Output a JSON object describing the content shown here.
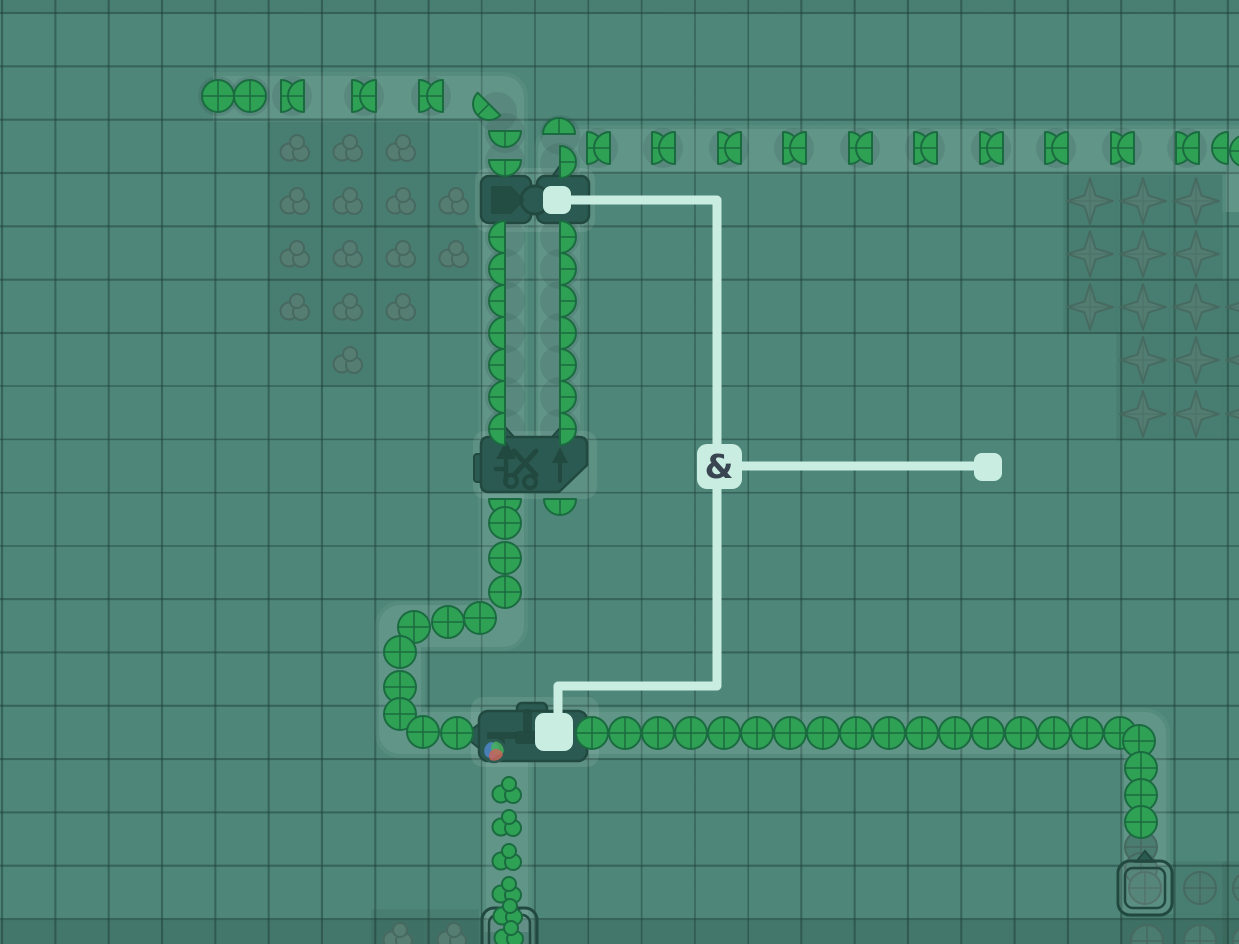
{
  "meta": {
    "view": "factory-wire-layer",
    "width": 1239,
    "height": 944
  },
  "colors": {
    "base": "#4e8679",
    "machine": "#2b5a52",
    "machine_dark": "#22493f",
    "wire": "#c9eee1",
    "gate_bg": "#c9eee1",
    "gate_text": "#394551",
    "item_green": "#2fa155",
    "item_green_dark": "#1b6b40",
    "dim_fill": "#557d72",
    "dim_stroke": "#47695f",
    "dim_circle_fill": "#4a7c70",
    "belt_band": "rgba(222,248,240,0.09)",
    "belt_halo": "rgba(222,248,240,0.05)",
    "halo": "rgba(222,248,240,0.10)",
    "patch_cell": "rgba(18,44,38,0.09)",
    "ghost": "rgba(18,44,38,0.10)",
    "orb_blue": "#4f86c9",
    "orb_green": "#46b25e",
    "orb_red": "#c9655b"
  },
  "gate": {
    "label": "&",
    "x": 719,
    "y": 466,
    "size": 45
  },
  "pins": [
    {
      "x": 988,
      "y": 467,
      "size": 28
    }
  ],
  "wires": [
    [
      [
        571,
        200
      ],
      [
        717,
        200
      ],
      [
        717,
        446
      ]
    ],
    [
      [
        717,
        486
      ],
      [
        717,
        686
      ],
      [
        558,
        686
      ],
      [
        558,
        715
      ]
    ],
    [
      [
        740,
        466
      ],
      [
        976,
        466
      ]
    ]
  ],
  "belts": [
    [
      [
        213,
        97
      ],
      [
        503,
        97
      ],
      [
        503,
        180
      ]
    ],
    [
      [
        503,
        222
      ],
      [
        503,
        440
      ]
    ],
    [
      [
        559,
        222
      ],
      [
        559,
        440
      ]
    ],
    [
      [
        559,
        180
      ],
      [
        559,
        150
      ],
      [
        1247,
        150
      ],
      [
        1247,
        212
      ]
    ],
    [
      [
        503,
        488
      ],
      [
        503,
        626
      ],
      [
        400,
        626
      ],
      [
        400,
        733
      ],
      [
        480,
        733
      ]
    ],
    [
      [
        586,
        733
      ],
      [
        1145,
        733
      ],
      [
        1145,
        866
      ]
    ],
    [
      [
        507,
        758
      ],
      [
        507,
        932
      ]
    ]
  ],
  "halos": [
    [
      475,
      168,
      120,
      64
    ],
    [
      473,
      431,
      124,
      68
    ],
    [
      471,
      697,
      128,
      70
    ]
  ],
  "machines": [
    {
      "type": "processor",
      "x": 481,
      "y": 174
    },
    {
      "type": "cutter",
      "x": 481,
      "y": 437
    },
    {
      "type": "filter",
      "x": 479,
      "y": 703
    },
    {
      "type": "miner",
      "x": 482,
      "y": 908,
      "w": 55
    },
    {
      "type": "miner",
      "x": 1118,
      "y": 861,
      "w": 54
    }
  ],
  "patch_cells": [
    [
      295,
      148
    ],
    [
      348,
      148
    ],
    [
      401,
      148
    ],
    [
      295,
      201
    ],
    [
      348,
      201
    ],
    [
      401,
      201
    ],
    [
      454,
      201
    ],
    [
      295,
      254
    ],
    [
      348,
      254
    ],
    [
      401,
      254
    ],
    [
      454,
      254
    ],
    [
      295,
      307
    ],
    [
      348,
      307
    ],
    [
      401,
      307
    ],
    [
      348,
      360
    ],
    [
      398,
      936
    ],
    [
      452,
      936
    ],
    [
      1090,
      201
    ],
    [
      1143,
      201
    ],
    [
      1196,
      201
    ],
    [
      1090,
      254
    ],
    [
      1143,
      254
    ],
    [
      1196,
      254
    ],
    [
      1090,
      307
    ],
    [
      1143,
      307
    ],
    [
      1196,
      307
    ],
    [
      1249,
      307
    ],
    [
      1143,
      360
    ],
    [
      1196,
      360
    ],
    [
      1249,
      360
    ],
    [
      1143,
      414
    ],
    [
      1196,
      414
    ],
    [
      1249,
      414
    ],
    [
      1200,
      888
    ],
    [
      1147,
      941
    ],
    [
      1200,
      941
    ],
    [
      1249,
      888
    ],
    [
      1249,
      941
    ]
  ],
  "dim_sprites": [
    [
      295,
      148,
      "cluster"
    ],
    [
      348,
      148,
      "cluster"
    ],
    [
      401,
      148,
      "cluster"
    ],
    [
      295,
      201,
      "cluster"
    ],
    [
      348,
      201,
      "cluster"
    ],
    [
      401,
      201,
      "cluster"
    ],
    [
      454,
      201,
      "cluster"
    ],
    [
      295,
      254,
      "cluster"
    ],
    [
      348,
      254,
      "cluster"
    ],
    [
      401,
      254,
      "cluster"
    ],
    [
      454,
      254,
      "cluster"
    ],
    [
      295,
      307,
      "cluster"
    ],
    [
      348,
      307,
      "cluster"
    ],
    [
      401,
      307,
      "cluster"
    ],
    [
      348,
      360,
      "cluster"
    ],
    [
      398,
      936,
      "cluster"
    ],
    [
      452,
      936,
      "cluster"
    ],
    [
      1090,
      201,
      "star"
    ],
    [
      1143,
      201,
      "star"
    ],
    [
      1196,
      201,
      "star"
    ],
    [
      1090,
      254,
      "star"
    ],
    [
      1143,
      254,
      "star"
    ],
    [
      1196,
      254,
      "star"
    ],
    [
      1090,
      307,
      "star"
    ],
    [
      1143,
      307,
      "star"
    ],
    [
      1196,
      307,
      "star"
    ],
    [
      1249,
      307,
      "star"
    ],
    [
      1143,
      360,
      "star"
    ],
    [
      1196,
      360,
      "star"
    ],
    [
      1249,
      360,
      "star"
    ],
    [
      1143,
      414,
      "star"
    ],
    [
      1196,
      414,
      "star"
    ],
    [
      1249,
      414,
      "star"
    ],
    [
      1141,
      847,
      "circle"
    ],
    [
      1141,
      869,
      "circle"
    ],
    [
      1200,
      888,
      "circle"
    ],
    [
      1147,
      941,
      "circle"
    ],
    [
      1200,
      941,
      "circle"
    ],
    [
      1249,
      888,
      "circle"
    ],
    [
      1249,
      941,
      "circle"
    ],
    [
      1145,
      888,
      "circle"
    ]
  ],
  "ghosts": [
    [
      218,
      96
    ],
    [
      250,
      96
    ],
    [
      292,
      96
    ],
    [
      364,
      96
    ],
    [
      431,
      96
    ],
    [
      497,
      112
    ],
    [
      598,
      148
    ],
    [
      663,
      148
    ],
    [
      729,
      148
    ],
    [
      794,
      148
    ],
    [
      860,
      148
    ],
    [
      925,
      148
    ],
    [
      991,
      148
    ],
    [
      1056,
      148
    ],
    [
      1122,
      148
    ],
    [
      1187,
      148
    ],
    [
      505,
      133
    ],
    [
      505,
      161
    ],
    [
      560,
      135
    ],
    [
      560,
      163
    ],
    [
      505,
      237
    ],
    [
      505,
      269
    ],
    [
      505,
      301
    ],
    [
      505,
      333
    ],
    [
      505,
      365
    ],
    [
      505,
      397
    ],
    [
      505,
      429
    ],
    [
      560,
      237
    ],
    [
      560,
      269
    ],
    [
      560,
      301
    ],
    [
      560,
      333
    ],
    [
      560,
      365
    ],
    [
      560,
      397
    ],
    [
      560,
      429
    ]
  ],
  "items": [
    [
      218,
      96,
      "c"
    ],
    [
      250,
      96,
      "c"
    ],
    [
      281,
      96,
      "hr"
    ],
    [
      304,
      96,
      "hl"
    ],
    [
      352,
      96,
      "hr"
    ],
    [
      376,
      96,
      "hl"
    ],
    [
      419,
      96,
      "hr"
    ],
    [
      443,
      96,
      "hl"
    ],
    [
      489,
      104,
      "hl",
      -45
    ],
    [
      505,
      131,
      "hl",
      -90
    ],
    [
      505,
      160,
      "hl",
      -90
    ],
    [
      559,
      134,
      "hl",
      90
    ],
    [
      560,
      162,
      "hr"
    ],
    [
      587,
      148,
      "hr"
    ],
    [
      610,
      148,
      "hl"
    ],
    [
      652,
      148,
      "hr"
    ],
    [
      675,
      148,
      "hl"
    ],
    [
      718,
      148,
      "hr"
    ],
    [
      741,
      148,
      "hl"
    ],
    [
      783,
      148,
      "hr"
    ],
    [
      806,
      148,
      "hl"
    ],
    [
      849,
      148,
      "hr"
    ],
    [
      872,
      148,
      "hl"
    ],
    [
      914,
      148,
      "hr"
    ],
    [
      937,
      148,
      "hl"
    ],
    [
      980,
      148,
      "hr"
    ],
    [
      1003,
      148,
      "hl"
    ],
    [
      1045,
      148,
      "hr"
    ],
    [
      1068,
      148,
      "hl"
    ],
    [
      1111,
      148,
      "hr"
    ],
    [
      1134,
      148,
      "hl"
    ],
    [
      1176,
      148,
      "hr"
    ],
    [
      1199,
      148,
      "hl"
    ],
    [
      1228,
      148,
      "hl"
    ],
    [
      1246,
      151,
      "c"
    ],
    [
      505,
      237,
      "hl"
    ],
    [
      505,
      269,
      "hl"
    ],
    [
      505,
      301,
      "hl"
    ],
    [
      505,
      333,
      "hl"
    ],
    [
      505,
      365,
      "hl"
    ],
    [
      505,
      397,
      "hl"
    ],
    [
      505,
      429,
      "hl"
    ],
    [
      560,
      237,
      "hr"
    ],
    [
      560,
      269,
      "hr"
    ],
    [
      560,
      301,
      "hr"
    ],
    [
      560,
      333,
      "hr"
    ],
    [
      560,
      365,
      "hr"
    ],
    [
      560,
      397,
      "hr"
    ],
    [
      560,
      429,
      "hr"
    ],
    [
      505,
      499,
      "hl",
      -90
    ],
    [
      560,
      499,
      "hl",
      -90
    ],
    [
      505,
      523,
      "c"
    ],
    [
      505,
      558,
      "c"
    ],
    [
      505,
      592,
      "c"
    ],
    [
      480,
      618,
      "c"
    ],
    [
      448,
      622,
      "c"
    ],
    [
      414,
      627,
      "c"
    ],
    [
      400,
      652,
      "c"
    ],
    [
      400,
      687,
      "c"
    ],
    [
      400,
      714,
      "c"
    ],
    [
      423,
      732,
      "c"
    ],
    [
      457,
      733,
      "c"
    ],
    [
      592,
      733,
      "c"
    ],
    [
      625,
      733,
      "c"
    ],
    [
      658,
      733,
      "c"
    ],
    [
      691,
      733,
      "c"
    ],
    [
      724,
      733,
      "c"
    ],
    [
      757,
      733,
      "c"
    ],
    [
      790,
      733,
      "c"
    ],
    [
      823,
      733,
      "c"
    ],
    [
      856,
      733,
      "c"
    ],
    [
      889,
      733,
      "c"
    ],
    [
      922,
      733,
      "c"
    ],
    [
      955,
      733,
      "c"
    ],
    [
      988,
      733,
      "c"
    ],
    [
      1021,
      733,
      "c"
    ],
    [
      1054,
      733,
      "c"
    ],
    [
      1087,
      733,
      "c"
    ],
    [
      1120,
      733,
      "c"
    ],
    [
      1139,
      741,
      "c"
    ],
    [
      1141,
      768,
      "c"
    ],
    [
      1141,
      795,
      "c"
    ],
    [
      1141,
      822,
      "c"
    ],
    [
      507,
      790,
      "cl"
    ],
    [
      507,
      823,
      "cl"
    ],
    [
      507,
      857,
      "cl"
    ],
    [
      507,
      890,
      "cl"
    ],
    [
      508,
      912,
      "cl"
    ],
    [
      509,
      934,
      "cl"
    ],
    [
      494,
      751,
      "orb"
    ]
  ]
}
